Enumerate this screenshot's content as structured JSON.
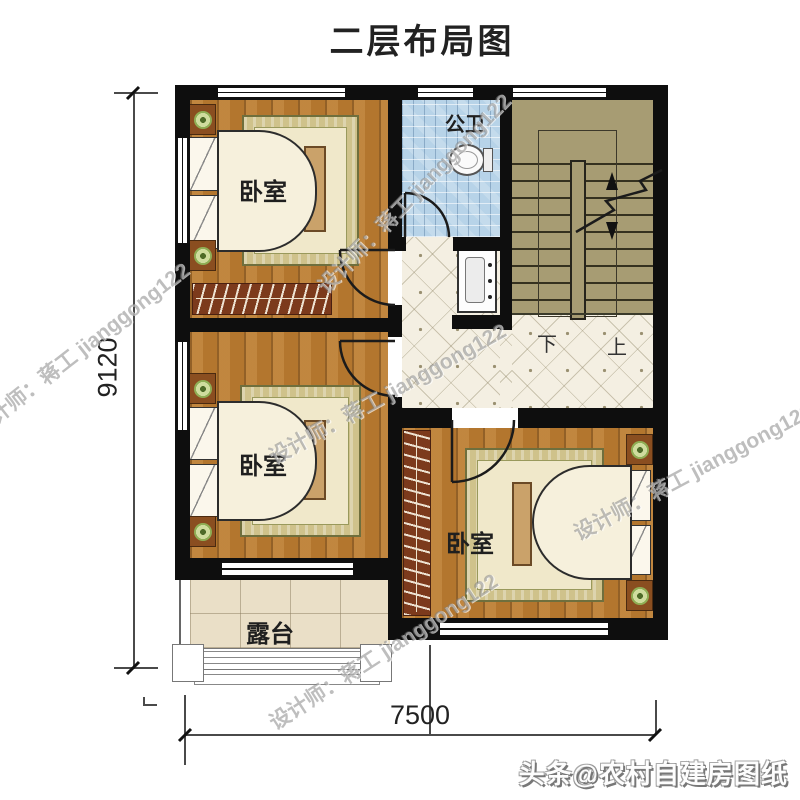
{
  "title": "二层布局图",
  "rooms": {
    "bedroom_top_left": "卧室",
    "bedroom_mid_left": "卧室",
    "bedroom_bottom_right": "卧室",
    "bathroom": "公卫",
    "terrace": "露台"
  },
  "stairs": {
    "down": "下",
    "up": "上"
  },
  "dimensions": {
    "vertical": "9120",
    "horizontal": "7500"
  },
  "watermarks": {
    "designer": "设计师：蒋工 jianggong122",
    "brand": "头条@农村自建房图纸"
  },
  "colors": {
    "wall": "#0e0e0e",
    "wood_floor": "#b3762e",
    "bath_tile": "#b7d3e8",
    "stair_fill": "#a79c73",
    "hall_tile": "#f4efe2",
    "terrace_tile": "#eadfc7"
  }
}
